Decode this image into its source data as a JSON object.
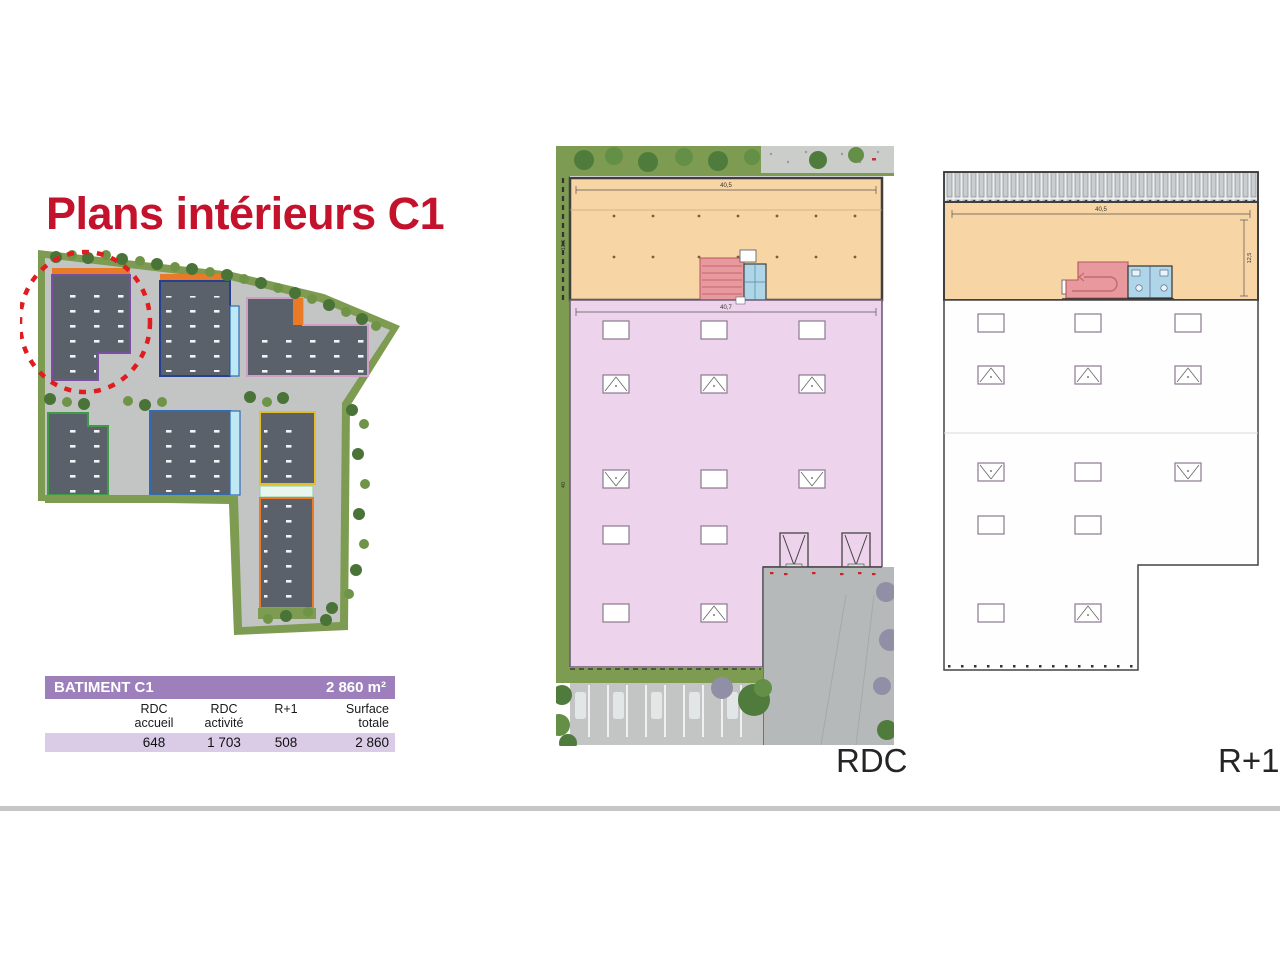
{
  "title": "Plans intérieurs C1",
  "table": {
    "header": "BATIMENT C1",
    "total_area": "2 860 m²",
    "columns": [
      "RDC\naccueil",
      "RDC\nactivité",
      "R+1",
      "Surface\ntotale"
    ],
    "values": [
      "648",
      "1 703",
      "508",
      "2 860"
    ]
  },
  "plans": {
    "rdc": {
      "label": "RDC",
      "dim_top": "40,5",
      "dim_mid": "40,7",
      "dim_left_orange": "12,5",
      "dim_left_pink": "40"
    },
    "r1": {
      "label": "R+1",
      "dim_top": "40,5",
      "dim_right": "12,5"
    }
  },
  "colors": {
    "accent": "#c4122d",
    "circleRed": "#e11c1f",
    "purple": "#9c7fbb",
    "purpleLight": "#dacbe7",
    "orange": "#f8d5a5",
    "pink": "#eed3ec",
    "olive": "#7d9b51",
    "roof": "#5a616b",
    "road": "#c3c5c5",
    "courtyard": "#b6b9ba",
    "stairPink": "#e8999e",
    "sanitaryBlue": "#aed6e8"
  }
}
